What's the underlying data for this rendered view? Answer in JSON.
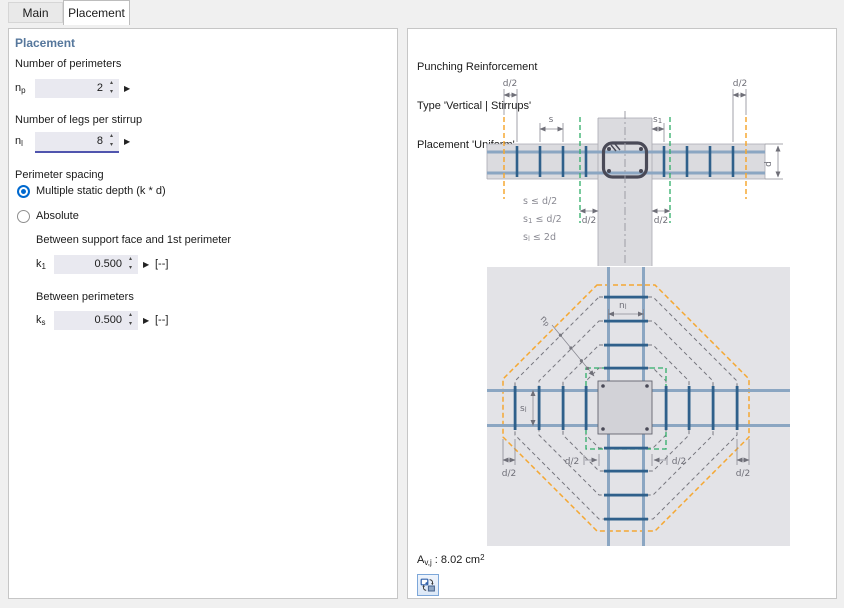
{
  "tabs": [
    {
      "label": "Main",
      "active": false
    },
    {
      "label": "Placement",
      "active": true
    }
  ],
  "left_panel": {
    "heading": "Placement",
    "np": {
      "section": "Number of perimeters",
      "base": "n",
      "sub": "p",
      "value": "2"
    },
    "nl": {
      "section": "Number of legs per stirrup",
      "base": "n",
      "sub": "l",
      "value": "8"
    },
    "spacing": {
      "label": "Perimeter spacing",
      "options": [
        {
          "label": "Multiple static depth (k * d)",
          "selected": true
        },
        {
          "label": "Absolute",
          "selected": false
        }
      ]
    },
    "k1": {
      "section": "Between support face and 1st perimeter",
      "base": "k",
      "sub": "1",
      "value": "0.500",
      "unit": "[--]"
    },
    "ks": {
      "section": "Between perimeters",
      "base": "k",
      "sub": "s",
      "value": "0.500",
      "unit": "[--]"
    }
  },
  "right_panel": {
    "header_lines": [
      "Punching Reinforcement",
      "Type 'Vertical | Stirrups'",
      "Placement 'Uniform'"
    ],
    "xsec": {
      "d2": "d/2",
      "s": "s",
      "s1_base": "s",
      "s1_sub": "1",
      "d": "d",
      "formulas": [
        {
          "base": "s",
          "sub": "",
          "rest": "  ≤ d/2"
        },
        {
          "base": "s",
          "sub": "1",
          "rest": " ≤ d/2"
        },
        {
          "base": "s",
          "sub": "l",
          "rest": " ≤ 2d"
        }
      ]
    },
    "plan": {
      "nl_base": "n",
      "nl_sub": "l",
      "np_base": "n",
      "np_sub": "p",
      "sl_base": "s",
      "sl_sub": "l",
      "d2": "d/2"
    },
    "result": {
      "symbol": "A",
      "symbol_sub": "v,j",
      "separator": " : ",
      "value": "8.02",
      "unit": " cm",
      "unit_sup": "2"
    }
  },
  "colors": {
    "accent_blue": "#0069cf",
    "focus_underline": "#5055ae",
    "heading_blue": "#56779c",
    "field_bg": "#e9e9f0",
    "perimeter_orange": "#f5a833",
    "perimeter_green": "#2fae68",
    "rebar_light": "#8ba6c2",
    "rebar_dark": "#2f608b",
    "concrete": "#dbdbdf"
  }
}
